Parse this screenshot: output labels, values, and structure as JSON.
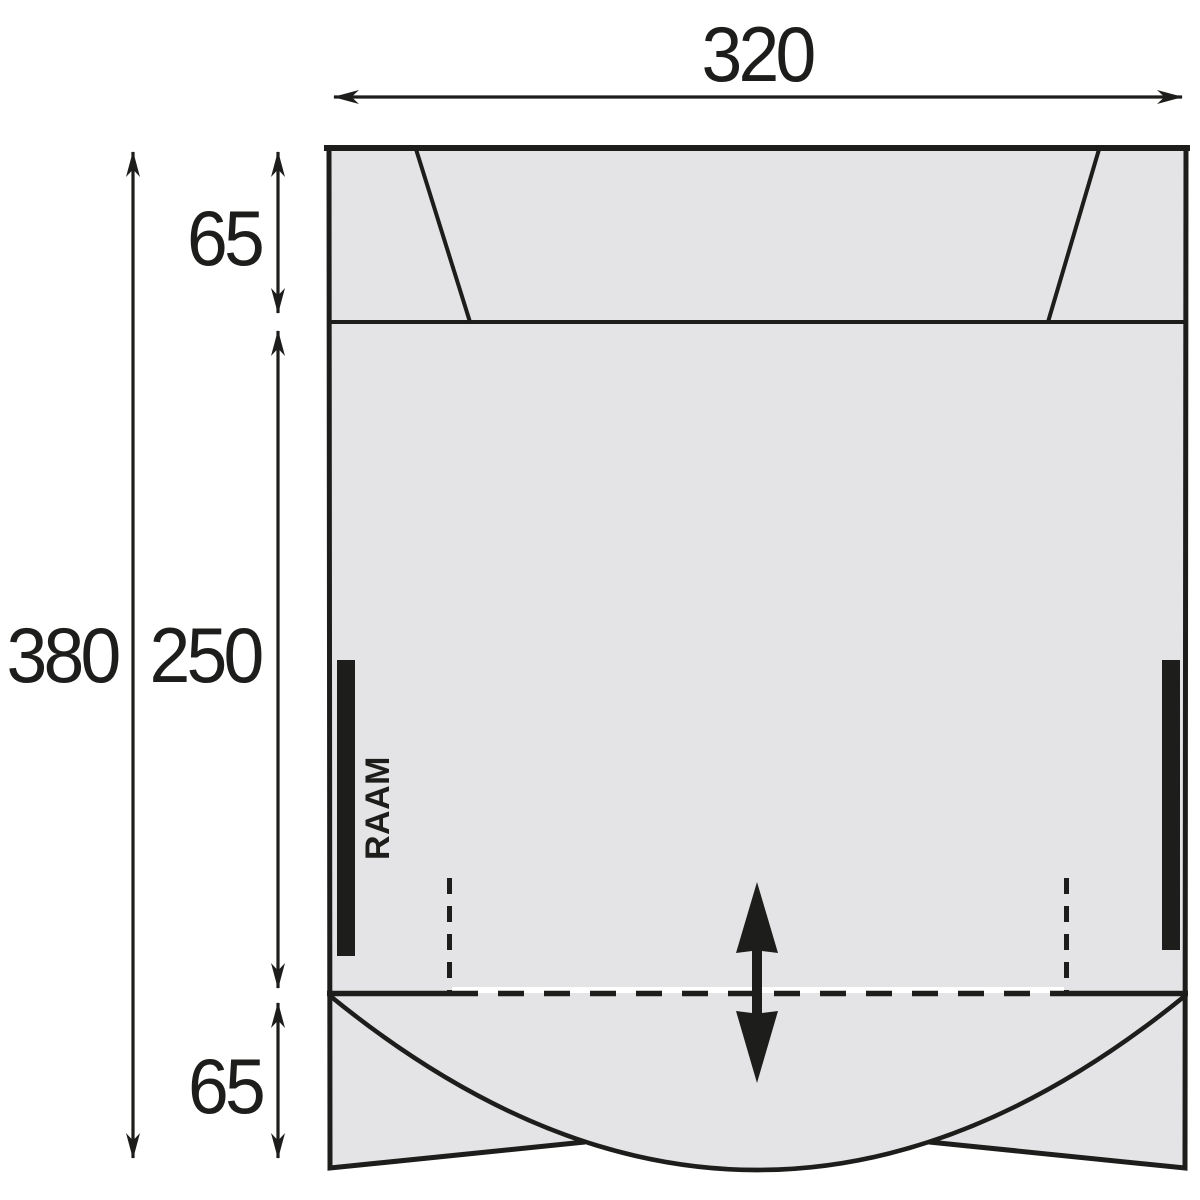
{
  "diagram": {
    "labels": {
      "width": "320",
      "total_height": "380",
      "roof_depth": "65",
      "main_depth": "250",
      "front_depth": "65",
      "window": "RAAM"
    },
    "colors": {
      "area_fill": "#e4e4e6",
      "line": "#1d1d1b",
      "background": "#ffffff"
    }
  }
}
